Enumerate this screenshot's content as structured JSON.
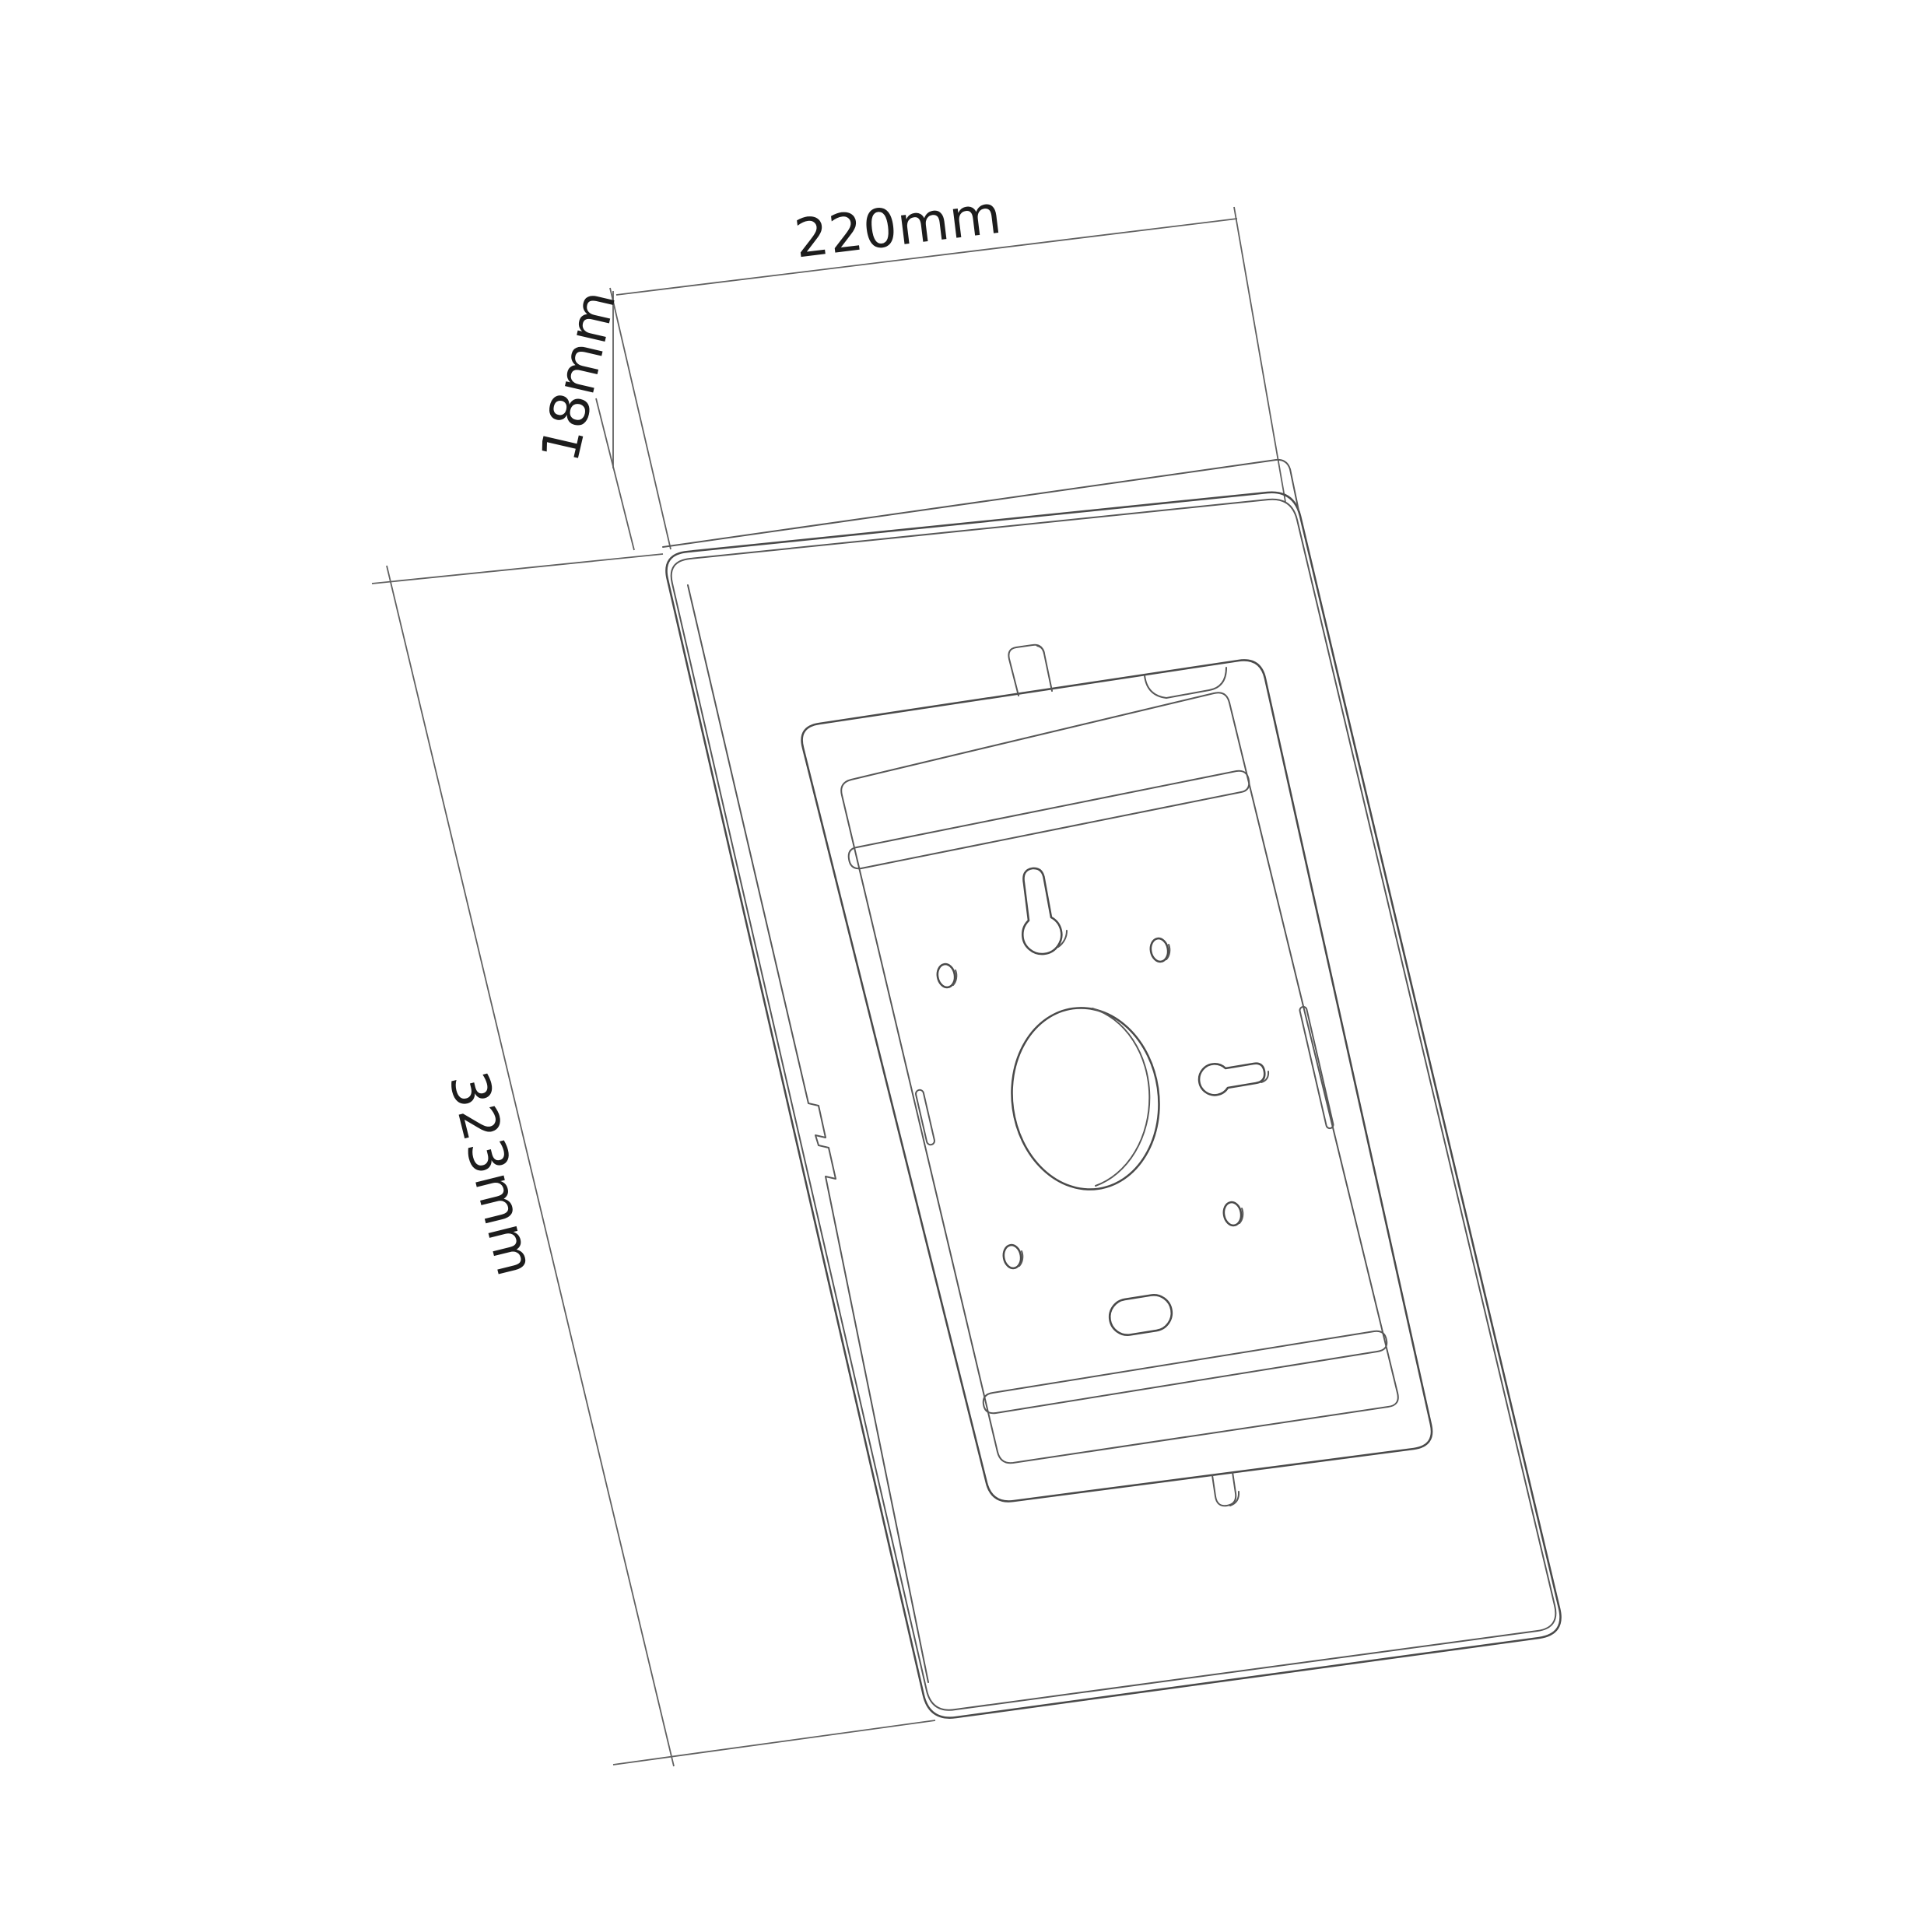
{
  "palette": {
    "background": "#ffffff",
    "object_line": "#4a4a4a",
    "dimension_line": "#606060",
    "label_text": "#1c1c1c"
  },
  "dimensions": {
    "width": {
      "label": "220mm",
      "value": 220,
      "unit": "mm"
    },
    "depth": {
      "label": "18mm",
      "value": 18,
      "unit": "mm"
    },
    "height": {
      "label": "323mm",
      "value": 323,
      "unit": "mm"
    }
  },
  "drawing": {
    "style": "monochrome wireframe technical drawing",
    "features": [
      {
        "name": "enclosure-outer-frame"
      },
      {
        "name": "enclosure-edge-fold"
      },
      {
        "name": "inner-recess-opening"
      },
      {
        "name": "back-mounting-plate"
      },
      {
        "name": "top-hook-tab"
      },
      {
        "name": "bottom-lock-tab"
      },
      {
        "name": "camera-cutout"
      },
      {
        "name": "keyhole-slot-vertical"
      },
      {
        "name": "keyhole-slot-horizontal"
      },
      {
        "name": "cable-hole-large"
      },
      {
        "name": "screw-hole-upper-left"
      },
      {
        "name": "screw-hole-upper-right"
      },
      {
        "name": "screw-hole-lower-left"
      },
      {
        "name": "screw-hole-lower-right"
      },
      {
        "name": "bottom-cable-slot"
      },
      {
        "name": "side-slot-left"
      },
      {
        "name": "side-slot-right"
      },
      {
        "name": "clamp-bar-top"
      },
      {
        "name": "clamp-bar-bottom"
      }
    ]
  }
}
